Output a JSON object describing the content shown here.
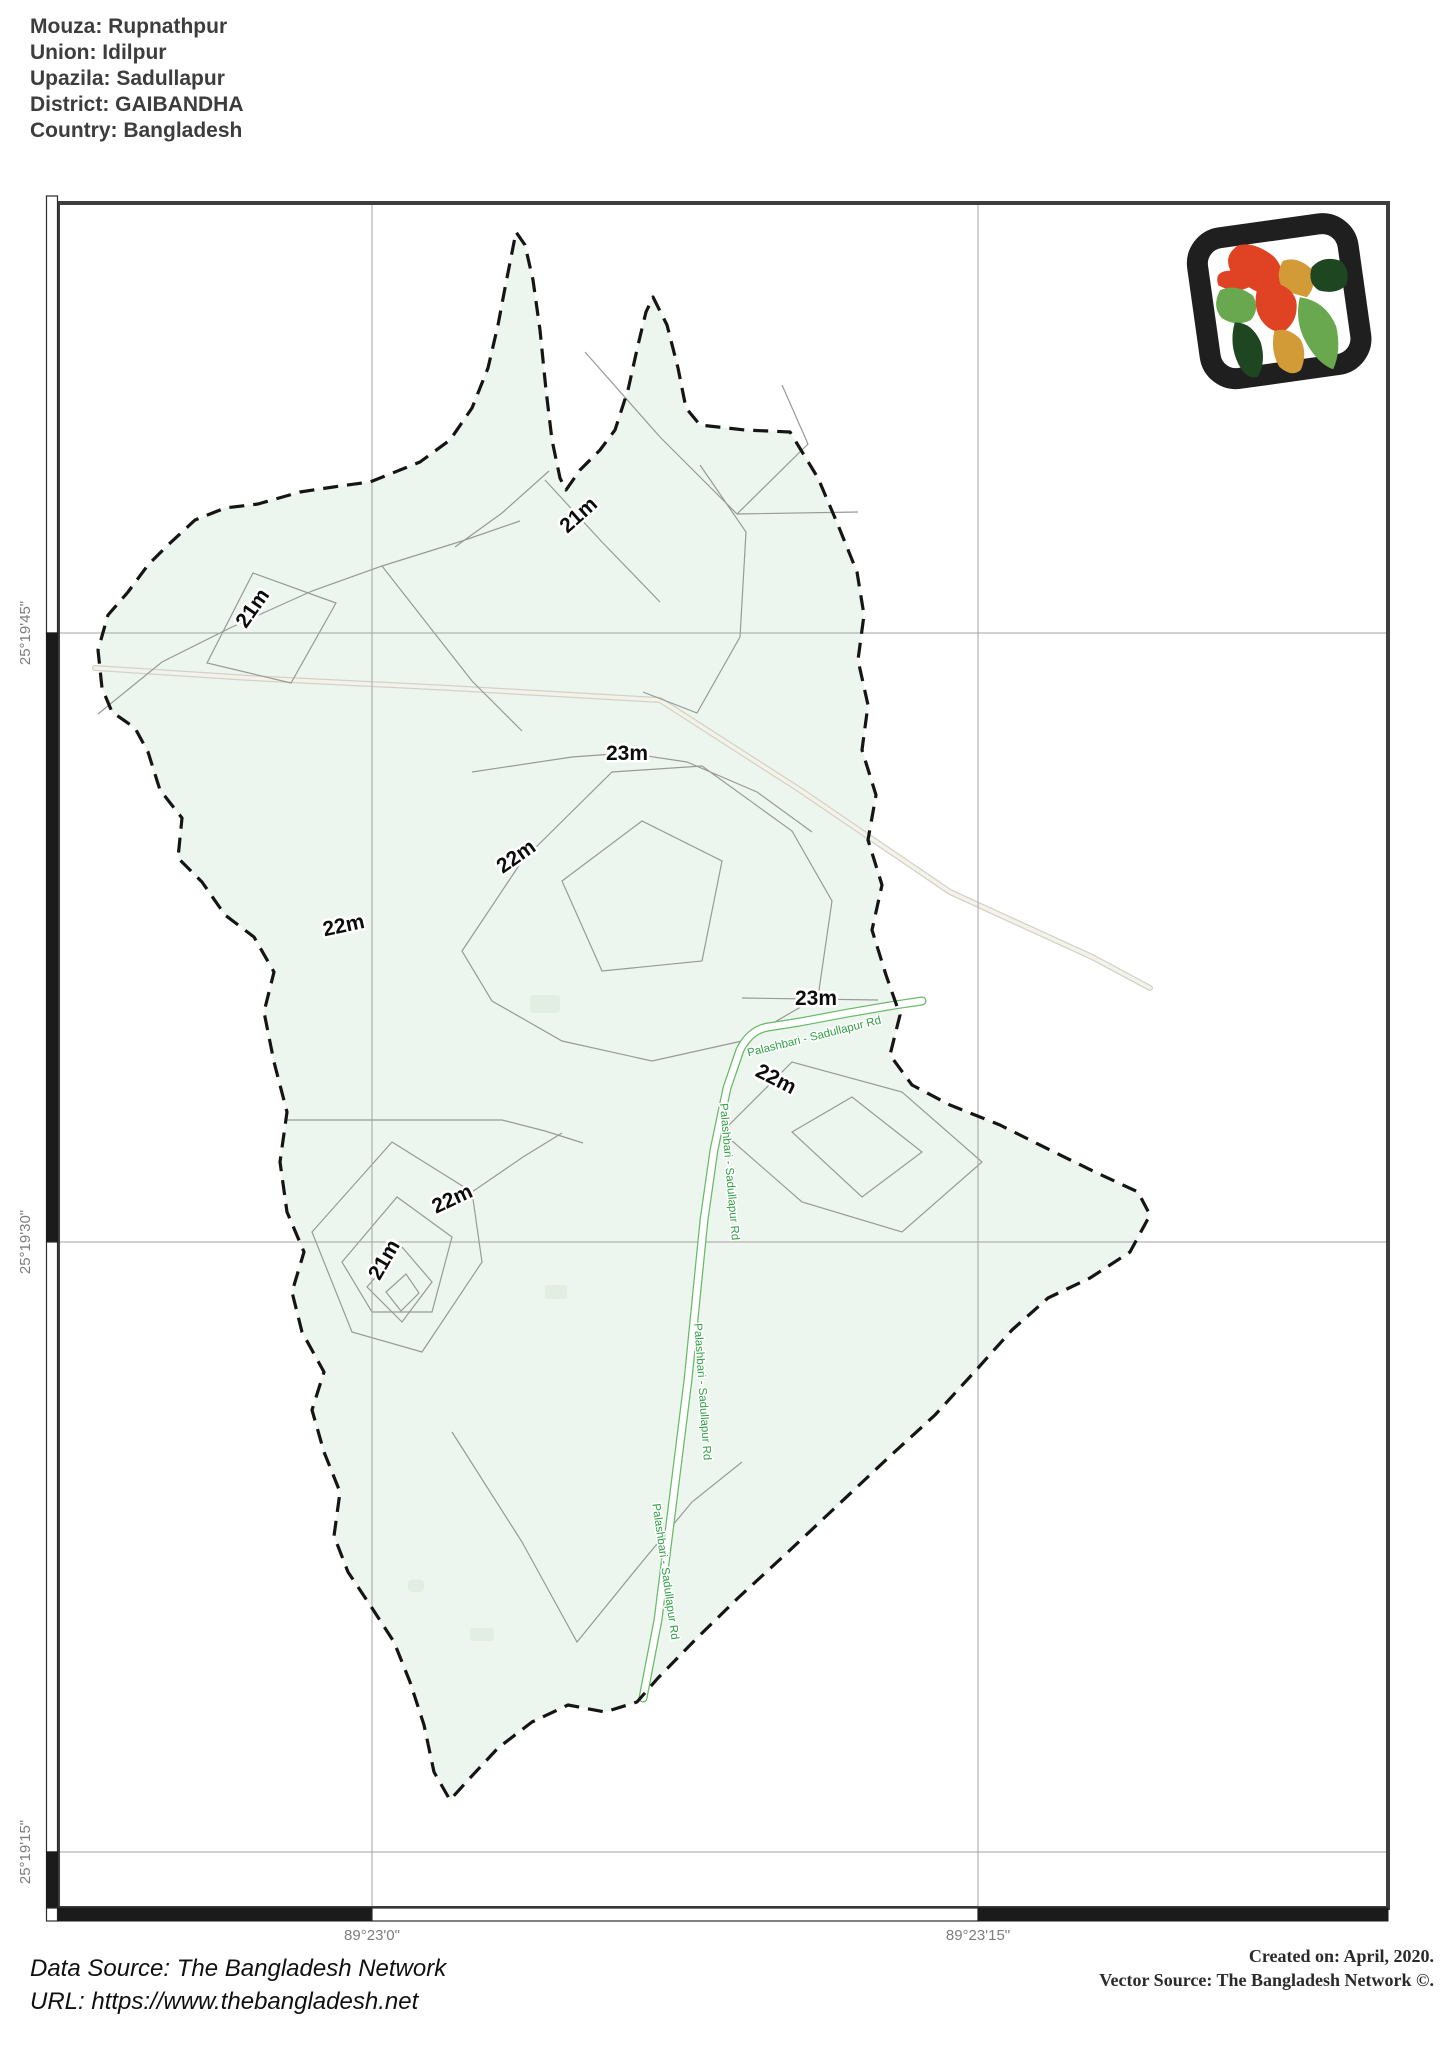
{
  "header": {
    "lines": [
      "Mouza: Rupnathpur",
      "Union: Idilpur",
      "Upazila: Sadullapur",
      "District: GAIBANDHA",
      "Country: Bangladesh"
    ]
  },
  "map": {
    "grid": {
      "lon": [
        {
          "text": "89°23'0\""
        },
        {
          "text": "89°23'15\""
        }
      ],
      "lat": [
        {
          "text": "25°19'45\""
        },
        {
          "text": "25°19'30\""
        },
        {
          "text": "25°19'15\""
        }
      ]
    },
    "contour_labels": [
      {
        "text": "21m"
      },
      {
        "text": "21m"
      },
      {
        "text": "23m"
      },
      {
        "text": "22m"
      },
      {
        "text": "22m"
      },
      {
        "text": "23m"
      },
      {
        "text": "22m"
      },
      {
        "text": "22m"
      },
      {
        "text": "21m"
      }
    ],
    "road_label": "Palashbari - Sadullapur Rd",
    "colors": {
      "mouza_fill": "#edf5ef",
      "boundary": "#151515",
      "contour": "#999a97",
      "road_green": "#66bb66",
      "road_label_green": "#2f9e44",
      "coordinate_text": "#7d7d7d",
      "logo_red": "#e04323",
      "logo_green": "#6aa84f",
      "logo_dark_green": "#1e4620",
      "logo_gold": "#d29b38"
    }
  },
  "footer": {
    "data_source": "Data Source: The Bangladesh Network",
    "url": "URL: https://www.thebangladesh.net",
    "created": "Created on: April, 2020.",
    "vector_source": "Vector Source: The Bangladesh Network ©."
  }
}
